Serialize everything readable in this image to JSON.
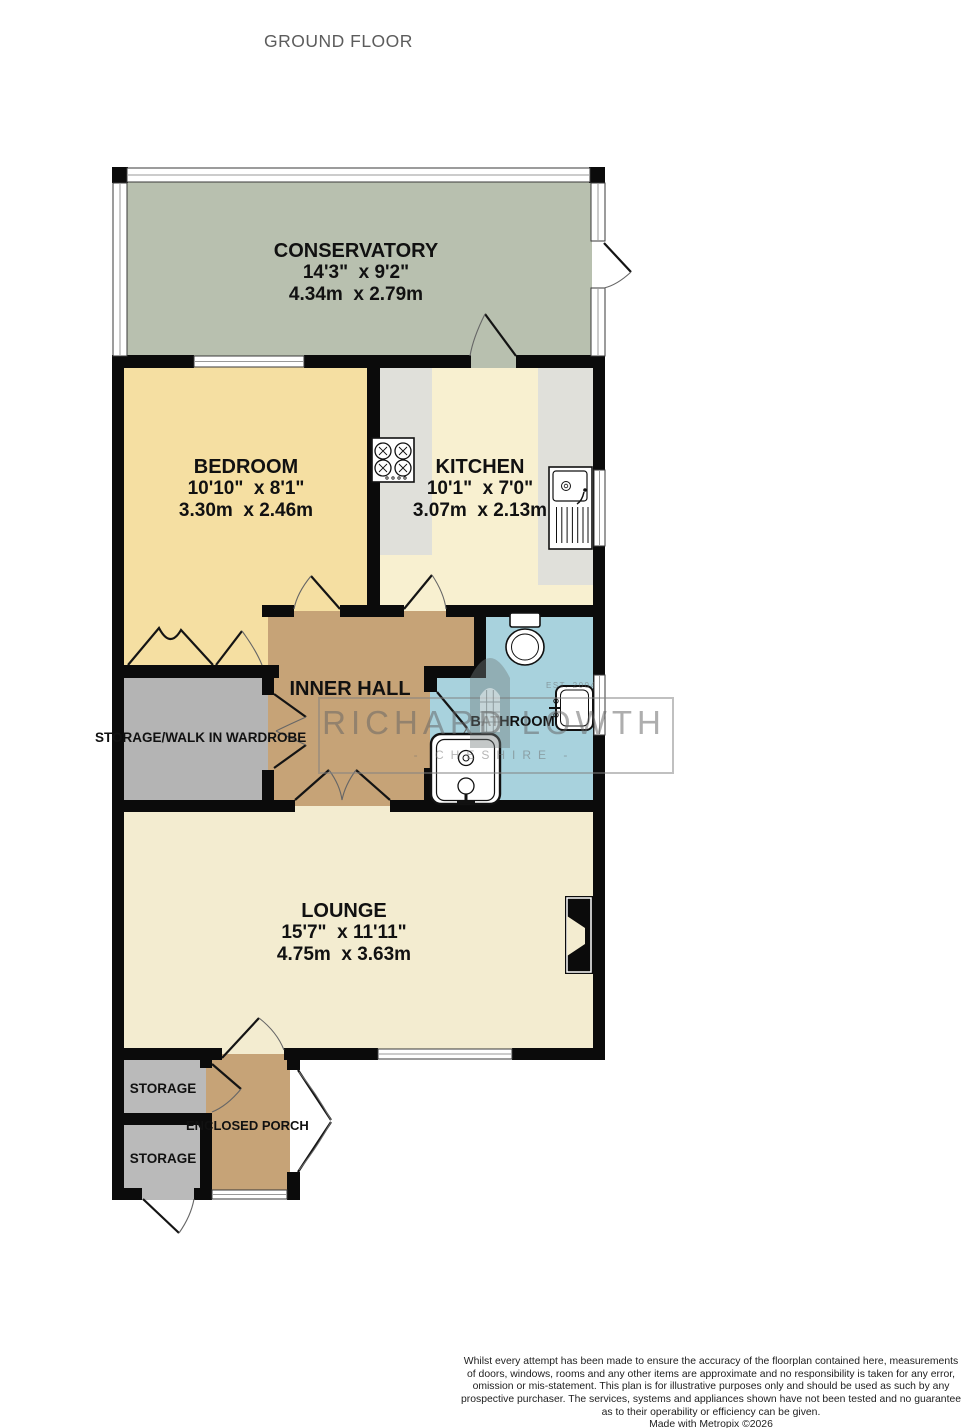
{
  "title": "GROUND FLOOR",
  "rooms": {
    "conservatory": {
      "name": "CONSERVATORY",
      "imperial": "14'3\"  x 9'2\"",
      "metric": "4.34m  x 2.79m"
    },
    "bedroom": {
      "name": "BEDROOM",
      "imperial": "10'10\"  x 8'1\"",
      "metric": "3.30m  x 2.46m"
    },
    "kitchen": {
      "name": "KITCHEN",
      "imperial": "10'1\"  x 7'0\"",
      "metric": "3.07m  x 2.13m"
    },
    "inner_hall": {
      "name": "INNER HALL"
    },
    "bathroom": {
      "name": "BATHROOM"
    },
    "wardrobe": {
      "name": "STORAGE/WALK IN WARDROBE"
    },
    "lounge": {
      "name": "LOUNGE",
      "imperial": "15'7\"  x 11'11\"",
      "metric": "4.75m  x 3.63m"
    },
    "storage_top": {
      "name": "STORAGE"
    },
    "storage_bottom": {
      "name": "STORAGE"
    },
    "porch": {
      "name": "ENCLOSED PORCH"
    }
  },
  "watermark": {
    "brand": "RICHARD LOWTH",
    "region": "- CHESHIRE -",
    "est": "EST. 2004"
  },
  "footer": {
    "lines": [
      "Whilst every attempt has been made to ensure the accuracy of the floorplan contained here, measurements",
      "of doors, windows, rooms and any other items are approximate and no responsibility is taken for any error,",
      "omission or mis-statement. This plan is for illustrative purposes only and should be used as such by any",
      "prospective purchaser. The services, systems and appliances shown have not been tested and no guarantee",
      "as to their operability or efficiency can be given."
    ],
    "credit": "Made with Metropix ©2026"
  },
  "colors": {
    "conservatory": "#b8c0af",
    "bedroom": "#f5dfa2",
    "kitchen": "#f8f0d0",
    "counter": "#e0e0da",
    "hall": "#c6a377",
    "bathroom": "#a8d2dd",
    "wardrobe": "#b4b4b4",
    "lounge": "#f3ecd0",
    "storage": "#bababa",
    "porch": "#c6a377",
    "wall": "#0b0b0b"
  }
}
